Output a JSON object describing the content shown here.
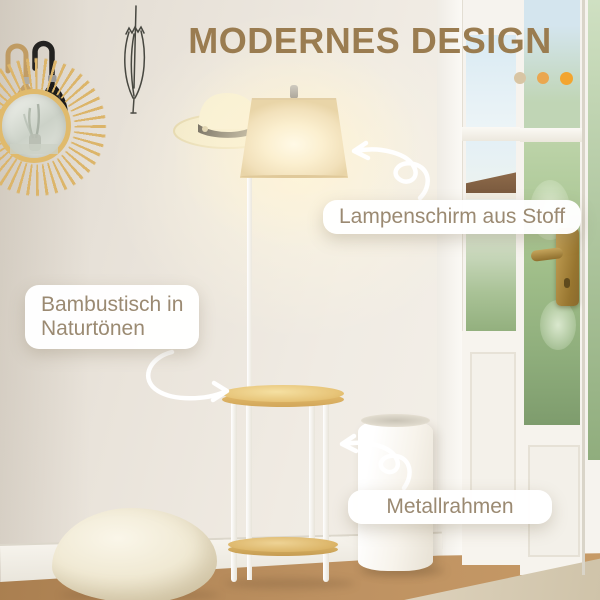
{
  "title": "MODERNES DESIGN",
  "callouts": {
    "lampshade": "Lampenschirm aus Stoff",
    "table_line1": "Bambustisch in",
    "table_line2": "Naturtönen",
    "frame": "Metallrahmen"
  },
  "decor": {
    "dots": [
      "#d8c5a4",
      "#eaa750",
      "#f3a52f"
    ]
  },
  "colors": {
    "title_text": "#9a7c50",
    "callout_text": "#9b8a72",
    "callout_bg": "#ffffff",
    "wall": "#ece6dd",
    "floor_wood": "#b98c58",
    "table_wood": "#e7c478",
    "metal_frame_white": "#ffffff",
    "umbrella_tan": "#c9a265",
    "umbrella_black": "#1d1d1d",
    "door_handle_brass": "#a4803a",
    "mirror_rattan": "#dcb466",
    "lamp_glow": "#fff4d6"
  }
}
